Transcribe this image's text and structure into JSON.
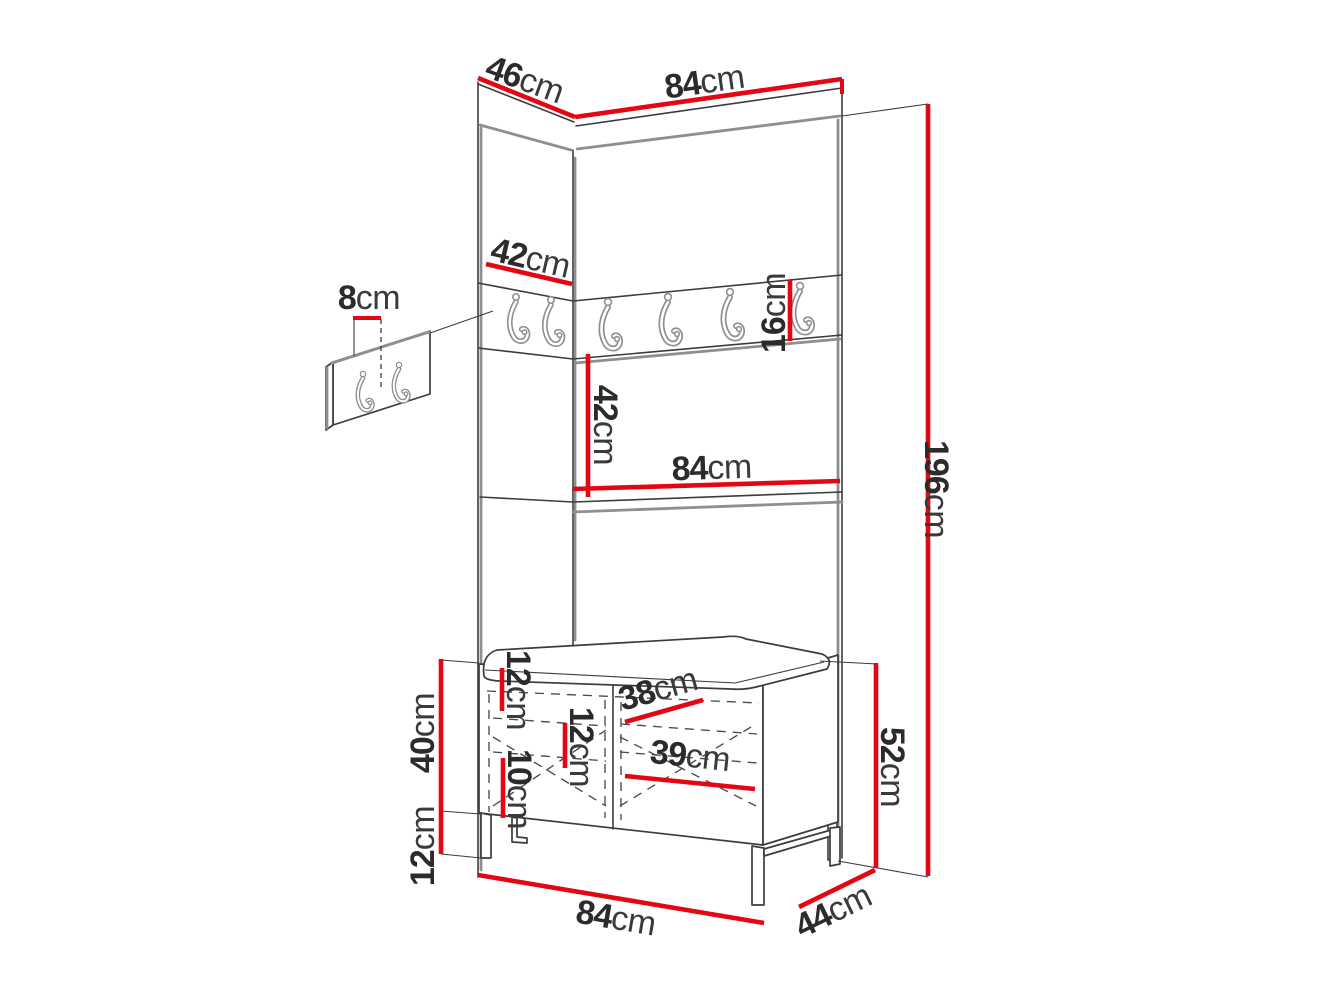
{
  "diagram": {
    "type": "furniture-dimension-drawing",
    "subject": "hallway wardrobe with coat-hook panels, shelf and shoe bench",
    "unit_of_measure": "cm"
  },
  "colors": {
    "dimension_red": "#e30613",
    "outline_dark": "#3c3c3c",
    "panel_gray": "#8f8f8f",
    "label_text": "#2b2b2b"
  },
  "features": {
    "main_hook_count": 6,
    "detail_panel_hook_count": 2
  },
  "dimensions": {
    "top_depth": {
      "value": "46",
      "unit": "cm"
    },
    "top_width": {
      "value": "84",
      "unit": "cm"
    },
    "hook_panel_width": {
      "value": "42",
      "unit": "cm"
    },
    "hook_spacing": {
      "value": "8",
      "unit": "cm"
    },
    "hook_panel_height": {
      "value": "16",
      "unit": "cm"
    },
    "middle_section_height": {
      "value": "42",
      "unit": "cm"
    },
    "shelf_width": {
      "value": "84",
      "unit": "cm"
    },
    "total_height": {
      "value": "196",
      "unit": "cm"
    },
    "bench_top_section": {
      "value": "12",
      "unit": "cm"
    },
    "bench_shelf_width_upper": {
      "value": "38",
      "unit": "cm"
    },
    "bench_middle_section": {
      "value": "12",
      "unit": "cm"
    },
    "bench_bottom_section": {
      "value": "10",
      "unit": "cm"
    },
    "bench_shelf_width_lower": {
      "value": "39",
      "unit": "cm"
    },
    "bench_body_height": {
      "value": "40",
      "unit": "cm"
    },
    "bench_leg_height": {
      "value": "12",
      "unit": "cm"
    },
    "bench_total_height": {
      "value": "52",
      "unit": "cm"
    },
    "bench_width": {
      "value": "84",
      "unit": "cm"
    },
    "bench_depth": {
      "value": "44",
      "unit": "cm"
    }
  }
}
